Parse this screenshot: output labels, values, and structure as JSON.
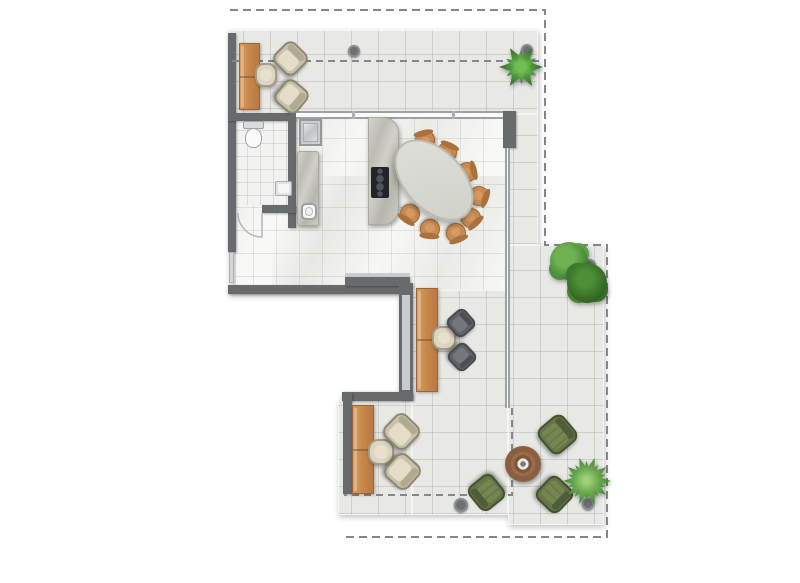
{
  "canvas": {
    "width": 800,
    "height": 583,
    "background": "#ffffff"
  },
  "palette": {
    "wall": "#686b6e",
    "boundary_dash": "#83868a",
    "terrace_tile": "#e8e8e5",
    "indoor_tile": "#f0f0ed",
    "wood": "#c98a50",
    "beige_fabric": "#ded6c1",
    "gray_fabric": "#5f6367",
    "green_fabric": "#64754a",
    "marble": "#c6c6bf",
    "table_top": "#d8d8d2",
    "plant_green": "#3c7a2f",
    "coffee_table_brown": "#996b48"
  },
  "plan": {
    "base": [
      {
        "name": "terrace-slab-top",
        "kind": "terrace",
        "x": 228,
        "y": 30,
        "w": 310,
        "h": 84
      },
      {
        "name": "terrace-slab-right-upper",
        "kind": "terrace",
        "x": 508,
        "y": 114,
        "w": 30,
        "h": 131
      },
      {
        "name": "terrace-slab-right-lower",
        "kind": "terrace",
        "x": 508,
        "y": 245,
        "w": 96,
        "h": 280
      },
      {
        "name": "terrace-slab-mid",
        "kind": "terrace",
        "x": 412,
        "y": 290,
        "w": 96,
        "h": 225
      },
      {
        "name": "terrace-slab-lounge",
        "kind": "terrace",
        "x": 338,
        "y": 400,
        "w": 74,
        "h": 115
      },
      {
        "name": "indoor-floor",
        "kind": "indoor",
        "x": 236,
        "y": 114,
        "w": 272,
        "h": 176
      },
      {
        "name": "bathroom-floor",
        "kind": "bath-floor",
        "x": 236,
        "y": 121,
        "w": 52,
        "h": 84
      },
      {
        "name": "wall-left",
        "kind": "wall",
        "x": 228,
        "y": 33,
        "w": 8,
        "h": 219
      },
      {
        "name": "entry-door-leaf",
        "kind": "door-leaf",
        "x": 229,
        "y": 252,
        "w": 5,
        "h": 31
      },
      {
        "name": "wall-south-long",
        "kind": "wall",
        "x": 228,
        "y": 285,
        "w": 180,
        "h": 9
      },
      {
        "name": "wall-south-upper-trim",
        "kind": "trim",
        "x": 345,
        "y": 273,
        "w": 65,
        "h": 5
      },
      {
        "name": "wall-south-upper",
        "kind": "wall",
        "x": 345,
        "y": 277,
        "w": 65,
        "h": 9
      },
      {
        "name": "wall-east",
        "kind": "wall",
        "x": 399,
        "y": 283,
        "w": 14,
        "h": 117
      },
      {
        "name": "wall-east-window",
        "kind": "trim",
        "x": 402,
        "y": 295,
        "w": 8,
        "h": 95
      },
      {
        "name": "wall-lounge-north",
        "kind": "wall",
        "x": 342,
        "y": 392,
        "w": 71,
        "h": 9
      },
      {
        "name": "wall-lounge-west",
        "kind": "wall",
        "x": 343,
        "y": 392,
        "w": 9,
        "h": 102
      },
      {
        "name": "wall-bath-north",
        "kind": "wall",
        "x": 228,
        "y": 113,
        "w": 68,
        "h": 8
      },
      {
        "name": "wall-bath-east",
        "kind": "wall",
        "x": 288,
        "y": 113,
        "w": 8,
        "h": 115
      },
      {
        "name": "wall-bath-south",
        "kind": "wall",
        "x": 262,
        "y": 205,
        "w": 34,
        "h": 8
      },
      {
        "name": "window-north",
        "kind": "glass-h",
        "x": 296,
        "y": 111,
        "w": 207,
        "h": 8
      },
      {
        "name": "window-mullion-1",
        "kind": "mullion",
        "x": 352,
        "y": 111,
        "w": 3,
        "h": 8
      },
      {
        "name": "window-mullion-2",
        "kind": "mullion",
        "x": 452,
        "y": 111,
        "w": 3,
        "h": 8
      },
      {
        "name": "pillar-northeast",
        "kind": "wall",
        "x": 503,
        "y": 111,
        "w": 13,
        "h": 37
      },
      {
        "name": "glass-wall-east",
        "kind": "glass-v",
        "x": 505,
        "y": 148,
        "w": 5,
        "h": 260
      }
    ],
    "overlay": [
      {
        "name": "property-boundary",
        "points": "230,10 545,10 545,245 607,245 607,537 344,537",
        "stroke": "#83868a",
        "width": 2,
        "dash": "8 5"
      },
      {
        "name": "roof-overhang-top",
        "points": "232,61 543,61",
        "stroke": "#84878b",
        "width": 2,
        "dash": "7 5"
      },
      {
        "name": "roof-overhang-southeast",
        "points": "512,408 512,495 344,495",
        "stroke": "#84878b",
        "width": 2,
        "dash": "7 5"
      },
      {
        "name": "bathroom-door-arc",
        "d": "M 238 213 A 24 24 0 0 0 262 237 L 262 213",
        "stroke": "#b4b7b9",
        "width": 1.5
      }
    ],
    "furniture": [
      {
        "name": "terrace-bench-north",
        "kind": "bench",
        "x": 239,
        "y": 43,
        "w": 21,
        "h": 67
      },
      {
        "name": "side-table-north",
        "kind": "side-table",
        "x": 255,
        "y": 63,
        "w": 22,
        "h": 24
      },
      {
        "name": "armchair-north-1",
        "kind": "armchair",
        "x": 276,
        "y": 44,
        "w": 29,
        "h": 29,
        "rot": 45
      },
      {
        "name": "armchair-north-2",
        "kind": "armchair",
        "x": 277,
        "y": 82,
        "w": 29,
        "h": 29,
        "rot": 130
      },
      {
        "name": "toilet",
        "kind": "toilet",
        "x": 243,
        "y": 121,
        "w": 21,
        "h": 27
      },
      {
        "name": "washbasin",
        "kind": "basin",
        "x": 275,
        "y": 181,
        "w": 17,
        "h": 15
      },
      {
        "name": "kitchen-appliance",
        "kind": "appliance",
        "x": 299,
        "y": 119,
        "w": 23,
        "h": 27
      },
      {
        "name": "kitchen-counter",
        "kind": "counter",
        "x": 297,
        "y": 151,
        "w": 22,
        "h": 75
      },
      {
        "name": "kitchen-sink",
        "kind": "sink",
        "x": 301,
        "y": 203,
        "w": 16,
        "h": 17
      },
      {
        "name": "kitchen-island",
        "kind": "island",
        "x": 368,
        "y": 117,
        "w": 31,
        "h": 108
      },
      {
        "name": "cooktop",
        "kind": "cooktop",
        "x": 371,
        "y": 167,
        "w": 18,
        "h": 31
      },
      {
        "name": "dining-chair-1",
        "kind": "chair-dining",
        "x": 415,
        "y": 130,
        "w": 20,
        "h": 20,
        "rot": -13
      },
      {
        "name": "dining-chair-2",
        "kind": "chair-dining",
        "x": 437,
        "y": 142,
        "w": 20,
        "h": 20,
        "rot": 25
      },
      {
        "name": "dining-chair-3",
        "kind": "chair-dining",
        "x": 457,
        "y": 162,
        "w": 20,
        "h": 20,
        "rot": 76
      },
      {
        "name": "dining-chair-4",
        "kind": "chair-dining",
        "x": 469,
        "y": 186,
        "w": 20,
        "h": 20,
        "rot": 110
      },
      {
        "name": "dining-chair-5",
        "kind": "chair-dining",
        "x": 461,
        "y": 208,
        "w": 20,
        "h": 20,
        "rot": 136
      },
      {
        "name": "dining-chair-6",
        "kind": "chair-dining",
        "x": 446,
        "y": 223,
        "w": 20,
        "h": 20,
        "rot": 158
      },
      {
        "name": "dining-chair-7",
        "kind": "chair-dining",
        "x": 420,
        "y": 219,
        "w": 20,
        "h": 20,
        "rot": 185
      },
      {
        "name": "dining-chair-8",
        "kind": "chair-dining",
        "x": 400,
        "y": 204,
        "w": 20,
        "h": 20,
        "rot": 215
      },
      {
        "name": "dining-table",
        "kind": "dining-table",
        "x": 386,
        "y": 150,
        "w": 96,
        "h": 60,
        "rot": 47
      },
      {
        "name": "desk-bench",
        "kind": "bench",
        "x": 416,
        "y": 288,
        "w": 22,
        "h": 104
      },
      {
        "name": "side-table-desk",
        "kind": "side-table",
        "x": 432,
        "y": 326,
        "w": 24,
        "h": 24
      },
      {
        "name": "office-chair-1",
        "kind": "chair-office",
        "x": 449,
        "y": 311,
        "w": 24,
        "h": 24,
        "rot": 49
      },
      {
        "name": "office-chair-2",
        "kind": "chair-office",
        "x": 450,
        "y": 345,
        "w": 24,
        "h": 24,
        "rot": 137
      },
      {
        "name": "lounge-bench",
        "kind": "bench",
        "x": 352,
        "y": 405,
        "w": 22,
        "h": 89
      },
      {
        "name": "side-table-lounge",
        "kind": "side-table",
        "x": 368,
        "y": 439,
        "w": 26,
        "h": 26
      },
      {
        "name": "armchair-lounge-1",
        "kind": "armchair",
        "x": 386,
        "y": 416,
        "w": 31,
        "h": 31,
        "rot": 44
      },
      {
        "name": "armchair-lounge-2",
        "kind": "armchair",
        "x": 387,
        "y": 456,
        "w": 31,
        "h": 31,
        "rot": 132
      },
      {
        "name": "coffee-table",
        "kind": "coffee-table",
        "x": 505,
        "y": 446,
        "w": 36,
        "h": 36
      },
      {
        "name": "green-chair-1",
        "kind": "chair-green",
        "x": 541,
        "y": 418,
        "w": 33,
        "h": 33,
        "rot": 50
      },
      {
        "name": "green-chair-2",
        "kind": "chair-green",
        "x": 471,
        "y": 477,
        "w": 31,
        "h": 31,
        "rot": 231
      },
      {
        "name": "green-chair-3",
        "kind": "chair-green",
        "x": 539,
        "y": 479,
        "w": 31,
        "h": 31,
        "rot": 134
      },
      {
        "name": "downlight-1",
        "kind": "downlight",
        "x": 348,
        "y": 45,
        "w": 12,
        "h": 12
      },
      {
        "name": "downlight-2",
        "kind": "downlight",
        "x": 521,
        "y": 44,
        "w": 12,
        "h": 12
      },
      {
        "name": "downlight-3",
        "kind": "downlight",
        "x": 584,
        "y": 259,
        "w": 12,
        "h": 12
      },
      {
        "name": "downlight-4",
        "kind": "downlight",
        "x": 454,
        "y": 498,
        "w": 14,
        "h": 14
      },
      {
        "name": "downlight-5",
        "kind": "downlight",
        "x": 582,
        "y": 498,
        "w": 12,
        "h": 12
      },
      {
        "name": "plant-agave",
        "kind": "plant-agave",
        "x": 499,
        "y": 45,
        "w": 44,
        "h": 44
      },
      {
        "name": "plant-bush-light",
        "kind": "plant-bush",
        "x": 550,
        "y": 242,
        "w": 38,
        "h": 38
      },
      {
        "name": "plant-bush-dark",
        "kind": "plant-bush-dark",
        "x": 567,
        "y": 263,
        "w": 40,
        "h": 40
      },
      {
        "name": "plant-palm",
        "kind": "plant-palm",
        "x": 563,
        "y": 457,
        "w": 48,
        "h": 48
      }
    ]
  }
}
